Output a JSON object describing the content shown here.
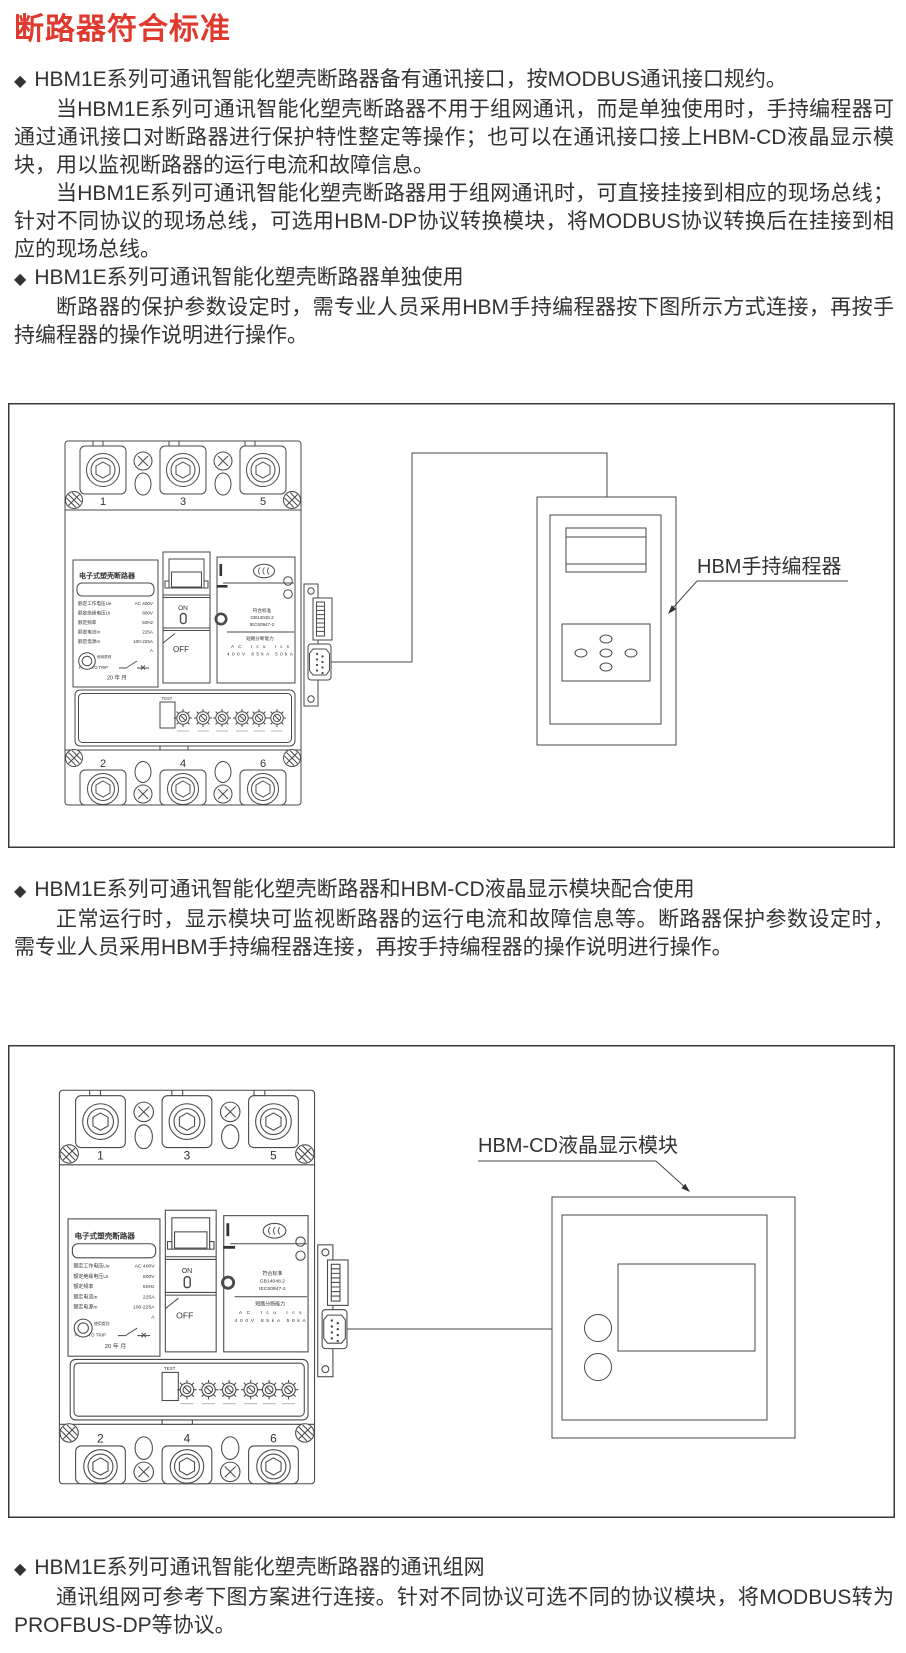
{
  "page": {
    "title": "断路器符合标准",
    "title_color": "#e0392e",
    "bullet_icon": "◆"
  },
  "sections": [
    {
      "heading": "HBM1E系列可通讯智能化塑壳断路器备有通讯接口，按MODBUS通讯接口规约。",
      "paragraphs": [
        "当HBM1E系列可通讯智能化塑壳断路器不用于组网通讯，而是单独使用时，手持编程器可通过通讯接口对断路器进行保护特性整定等操作；也可以在通讯接口接上HBM-CD液晶显示模块，用以监视断路器的运行电流和故障信息。",
        "当HBM1E系列可通讯智能化塑壳断路器用于组网通讯时，可直接挂接到相应的现场总线；针对不同协议的现场总线，可选用HBM-DP协议转换模块，将MODBUS协议转换后在挂接到相应的现场总线。"
      ]
    },
    {
      "heading": "HBM1E系列可通讯智能化塑壳断路器单独使用",
      "paragraphs": [
        "断路器的保护参数设定时，需专业人员采用HBM手持编程器按下图所示方式连接，再按手持编程器的操作说明进行操作。"
      ]
    },
    {
      "heading": "HBM1E系列可通讯智能化塑壳断路器和HBM-CD液晶显示模块配合使用",
      "paragraphs": [
        "正常运行时，显示模块可监视断路器的运行电流和故障信息等。断路器保护参数设定时，需专业人员采用HBM手持编程器连接，再按手持编程器的操作说明进行操作。"
      ]
    },
    {
      "heading": "HBM1E系列可通讯智能化塑壳断路器的通讯组网",
      "paragraphs": [
        "通讯组网可参考下图方案进行连接。针对不同协议可选不同的协议模块，将MODBUS转为PROFBUS-DP等协议。"
      ]
    }
  ],
  "diagram1": {
    "device_label": "HBM手持编程器"
  },
  "diagram2": {
    "device_label": "HBM-CD液晶显示模块"
  },
  "breaker": {
    "name_label": "电子式塑壳断路器",
    "specs": [
      {
        "label": "额定工作电压Ue",
        "value": "AC 400V"
      },
      {
        "label": "额定绝缘电压Ui",
        "value": "800V"
      },
      {
        "label": "额定频率",
        "value": "50Hz"
      },
      {
        "label": "额定电流In",
        "value": "225A"
      },
      {
        "label": "额定电源In",
        "value": "100-225A"
      }
    ],
    "ampere_unit": "A",
    "usage_label": "使用类别",
    "push_to_trip": "PUSH TO TRIP",
    "date_line": "20 年 月",
    "on": "ON",
    "off": "OFF",
    "test": "TEST",
    "terminals_top": [
      "1",
      "3",
      "5"
    ],
    "terminals_bottom": [
      "2",
      "4",
      "6"
    ],
    "standards_title": "符合标准",
    "standards": [
      "GB14048.2",
      "IEC60947-2"
    ],
    "breaking_title": "短路分断能力",
    "breaking_header": "AC Icu Ics",
    "breaking_values": "400V 85kA 50kA"
  }
}
